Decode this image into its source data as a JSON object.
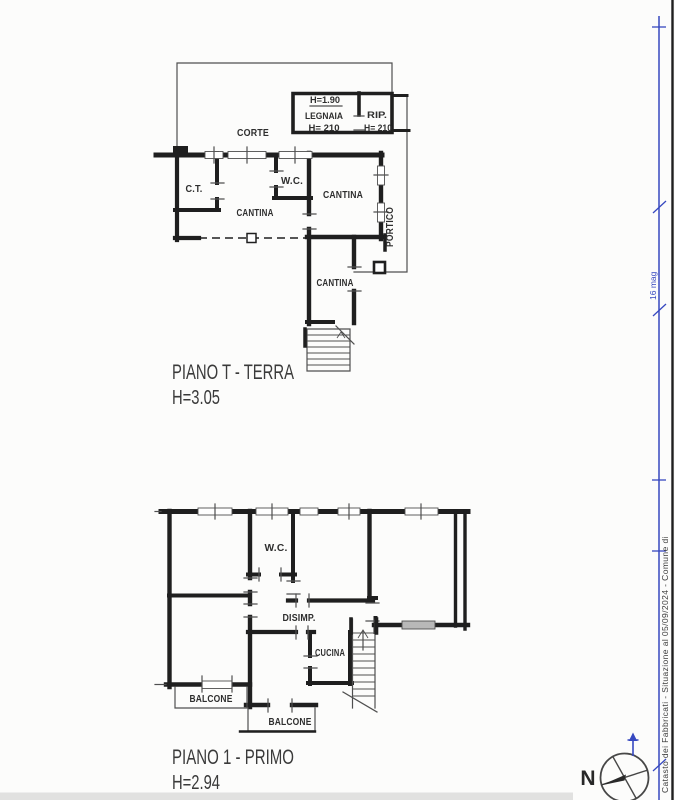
{
  "colors": {
    "wall": "#1f1f1f",
    "thin": "#4f4f4f",
    "text": "#2e2e2e",
    "blue": "#3648c0",
    "sill": "#b8b8b8",
    "artifact": "#c6c6c6"
  },
  "ground_floor": {
    "title": "PIANO T - TERRA",
    "height_label": "H=3.05",
    "rooms": {
      "corte": "CORTE",
      "legnaia": "LEGNAIA",
      "legnaia_h_top": "H=1.90",
      "legnaia_h_bottom": "H= 210",
      "rip": "RIP.",
      "rip_h": "H= 210",
      "ct": "C.T.",
      "wc": "W.C.",
      "cantina_mid": "CANTINA",
      "cantina_right": "CANTINA",
      "cantina_lower": "CANTINA",
      "portico": "PORTICO"
    }
  },
  "first_floor": {
    "title": "PIANO 1 - PRIMO",
    "height_label": "H=2.94",
    "rooms": {
      "wc": "W.C.",
      "disimp": "DISIMP.",
      "cucina": "CUCINA",
      "balcone_left": "BALCONE",
      "balcone_center": "BALCONE"
    }
  },
  "compass": {
    "north_label": "N"
  },
  "margin": {
    "blue_note": "16 mag",
    "footer": "Catasto dei Fabbricati - Situazione al 05/09/2024 - Comune di"
  }
}
